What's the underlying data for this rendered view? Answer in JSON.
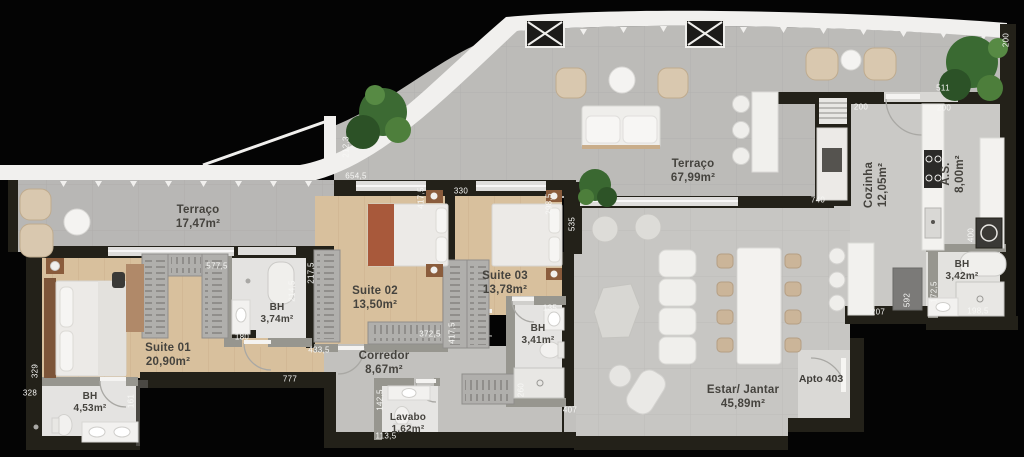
{
  "apto": {
    "text": "Apto 403",
    "x": 821,
    "y": 379
  },
  "rooms": [
    {
      "name": "Terraço",
      "area": "17,47m²",
      "x": 198,
      "y": 218,
      "size": "lg",
      "v": false
    },
    {
      "name": "Suite 01",
      "area": "20,90m²",
      "x": 168,
      "y": 356,
      "size": "lg",
      "v": false
    },
    {
      "name": "BH",
      "area": "4,53m²",
      "x": 90,
      "y": 403,
      "size": "sm",
      "v": false
    },
    {
      "name": "BH",
      "area": "3,74m²",
      "x": 277,
      "y": 314,
      "size": "sm",
      "v": false
    },
    {
      "name": "Suite 02",
      "area": "13,50m²",
      "x": 375,
      "y": 299,
      "size": "lg",
      "v": false
    },
    {
      "name": "Corredor",
      "area": "8,67m²",
      "x": 384,
      "y": 364,
      "size": "lg",
      "v": false
    },
    {
      "name": "Lavabo",
      "area": "1,62m²",
      "x": 408,
      "y": 424,
      "size": "sm",
      "v": false
    },
    {
      "name": "Suite 03",
      "area": "13,78m²",
      "x": 505,
      "y": 284,
      "size": "lg",
      "v": false
    },
    {
      "name": "BH",
      "area": "3,41m²",
      "x": 538,
      "y": 335,
      "size": "sm",
      "v": false
    },
    {
      "name": "Terraço",
      "area": "67,99m²",
      "x": 693,
      "y": 172,
      "size": "lg",
      "v": false
    },
    {
      "name": "Cozinha",
      "area": "12,05m²",
      "x": 877,
      "y": 185,
      "size": "lg",
      "v": true
    },
    {
      "name": "A.S.",
      "area": "8,00m²",
      "x": 954,
      "y": 174,
      "size": "lg",
      "v": true
    },
    {
      "name": "BH",
      "area": "3,42m²",
      "x": 962,
      "y": 271,
      "size": "sm",
      "v": false
    },
    {
      "name": "Estar/ Jantar",
      "area": "45,89m²",
      "x": 743,
      "y": 398,
      "size": "lg",
      "v": false
    }
  ],
  "dimensions": [
    {
      "text": "212,3",
      "x": 346,
      "y": 147,
      "v": true
    },
    {
      "text": "654,5",
      "x": 356,
      "y": 176,
      "v": false
    },
    {
      "text": "577,5",
      "x": 217,
      "y": 266,
      "v": false
    },
    {
      "text": "217,5",
      "x": 311,
      "y": 273,
      "v": true
    },
    {
      "text": "214,5",
      "x": 292,
      "y": 291,
      "v": true
    },
    {
      "text": "180",
      "x": 242,
      "y": 337,
      "v": false
    },
    {
      "text": "433,5",
      "x": 319,
      "y": 350,
      "v": false
    },
    {
      "text": "777",
      "x": 290,
      "y": 379,
      "v": false
    },
    {
      "text": "329",
      "x": 35,
      "y": 371,
      "v": true
    },
    {
      "text": "328",
      "x": 30,
      "y": 393,
      "v": false
    },
    {
      "text": "161",
      "x": 131,
      "y": 401,
      "v": true
    },
    {
      "text": "417,5",
      "x": 421,
      "y": 198,
      "v": true
    },
    {
      "text": "330",
      "x": 461,
      "y": 191,
      "v": false
    },
    {
      "text": "298,5",
      "x": 549,
      "y": 204,
      "v": true
    },
    {
      "text": "535",
      "x": 572,
      "y": 224,
      "v": true
    },
    {
      "text": "372,5",
      "x": 430,
      "y": 334,
      "v": false
    },
    {
      "text": "417,5",
      "x": 452,
      "y": 333,
      "v": true
    },
    {
      "text": "135",
      "x": 550,
      "y": 308,
      "v": false
    },
    {
      "text": "260",
      "x": 521,
      "y": 390,
      "v": true
    },
    {
      "text": "407",
      "x": 570,
      "y": 410,
      "v": false
    },
    {
      "text": "142,5",
      "x": 380,
      "y": 400,
      "v": true
    },
    {
      "text": "113,5",
      "x": 386,
      "y": 436,
      "v": false
    },
    {
      "text": "511",
      "x": 943,
      "y": 88,
      "v": false
    },
    {
      "text": "200",
      "x": 861,
      "y": 107,
      "v": false
    },
    {
      "text": "200",
      "x": 944,
      "y": 108,
      "v": false
    },
    {
      "text": "200",
      "x": 1006,
      "y": 40,
      "v": true
    },
    {
      "text": "740",
      "x": 818,
      "y": 200,
      "v": false
    },
    {
      "text": "400",
      "x": 971,
      "y": 235,
      "v": true
    },
    {
      "text": "207",
      "x": 878,
      "y": 312,
      "v": false
    },
    {
      "text": "592",
      "x": 907,
      "y": 300,
      "v": true
    },
    {
      "text": "172,5",
      "x": 934,
      "y": 292,
      "v": true
    },
    {
      "text": "198,5",
      "x": 978,
      "y": 311,
      "v": false
    }
  ]
}
